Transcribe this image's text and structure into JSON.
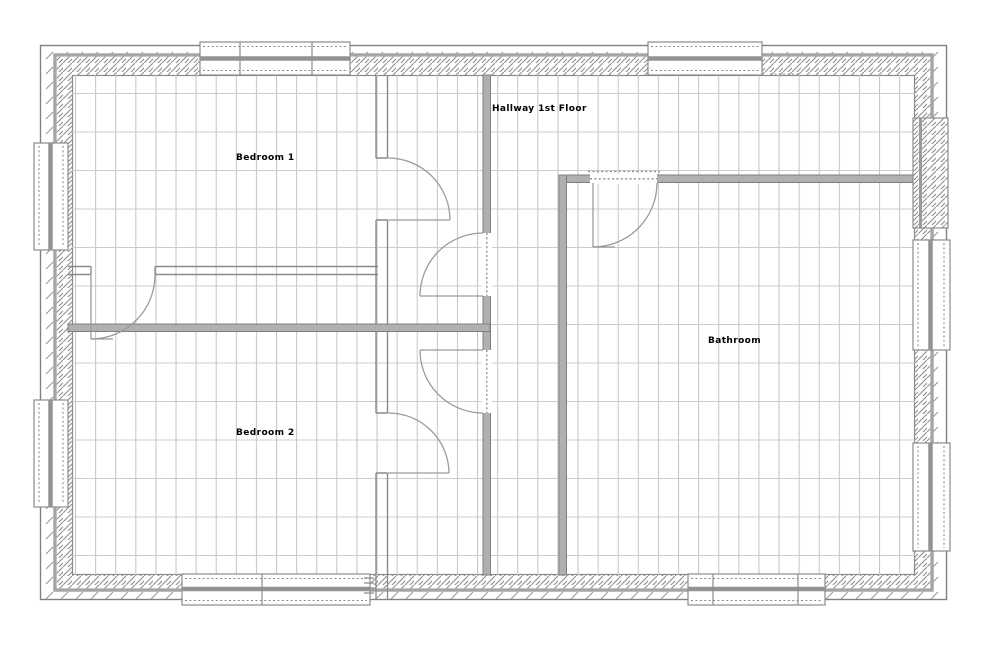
{
  "drawing": {
    "labels": {
      "bedroom1": "Bedroom 1",
      "bedroom2": "Bedroom 2",
      "hallway": "Hallway 1st Floor",
      "bathroom": "Bathroom"
    }
  },
  "palette": {
    "background": "#ffffff",
    "wall_fill_gray": "#b0b0b0",
    "wall_edge_gray": "#7f7f7f",
    "hatch_gray": "#8f8f8f",
    "grid_gray": "#c9c9c9",
    "door_arc_gray": "#9a9a9a",
    "text_color": "#000000"
  }
}
